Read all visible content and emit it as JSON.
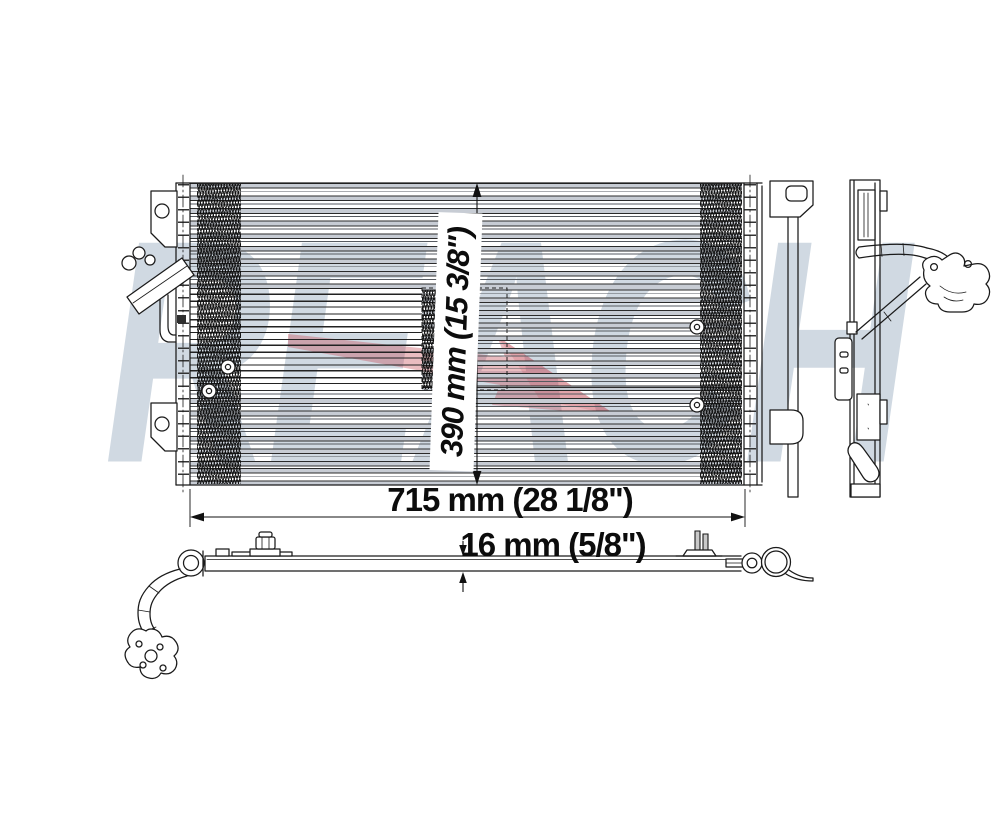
{
  "watermark": {
    "text": "REACH",
    "text_color": "rgba(170,186,203,0.55)",
    "arrow_color": "#c23a46"
  },
  "dimensions": {
    "width": {
      "label": "715 mm (28 1/8\")"
    },
    "height": {
      "label": "390 mm (15 3/8\")"
    },
    "depth": {
      "label": "16 mm (5/8\")"
    }
  },
  "colors": {
    "line": "#1a1a1a",
    "background": "#ffffff"
  }
}
